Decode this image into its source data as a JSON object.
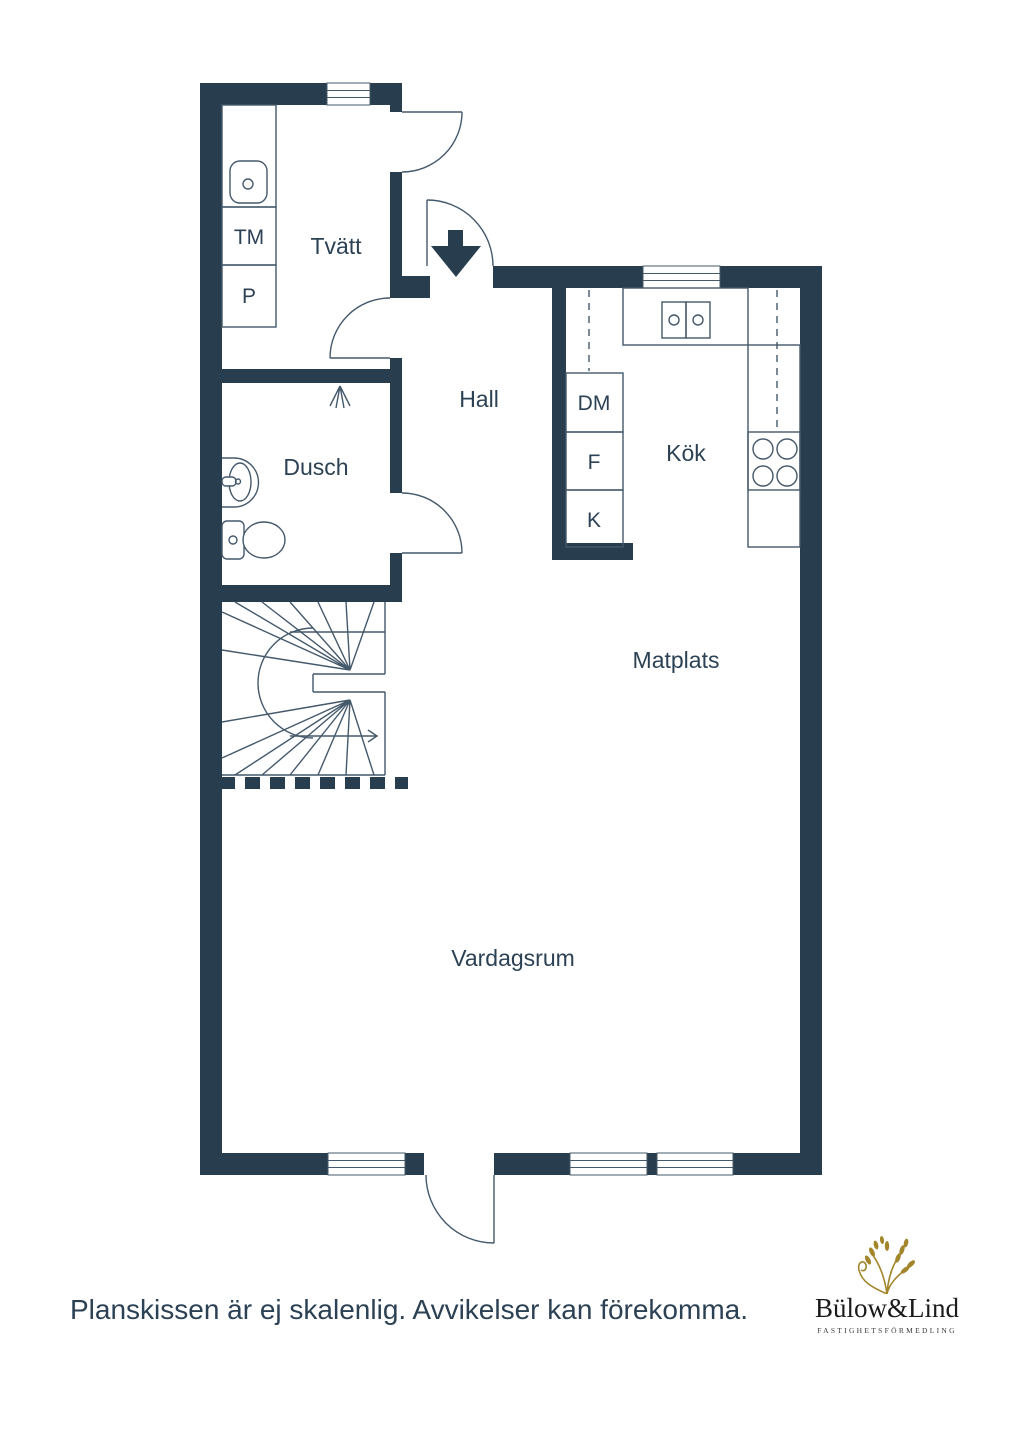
{
  "plan": {
    "rooms": {
      "tvatt": "Tvätt",
      "dusch": "Dusch",
      "hall": "Hall",
      "kok": "Kök",
      "matplats": "Matplats",
      "vardagsrum": "Vardagsrum"
    },
    "appliances": {
      "tm": "TM",
      "p": "P",
      "dm": "DM",
      "f": "F",
      "k": "K"
    }
  },
  "footer": {
    "disclaimer": "Planskissen är ej skalenlig. Avvikelser kan förekomma."
  },
  "logo": {
    "name": "Bülow&Lind",
    "tagline": "FASTIGHETSFÖRMEDLING"
  },
  "colors": {
    "wall": "#283e4e",
    "line": "#44596b",
    "text": "#2c4254",
    "logo_gold": "#a3852c",
    "logo_text": "#1b1b1b"
  }
}
